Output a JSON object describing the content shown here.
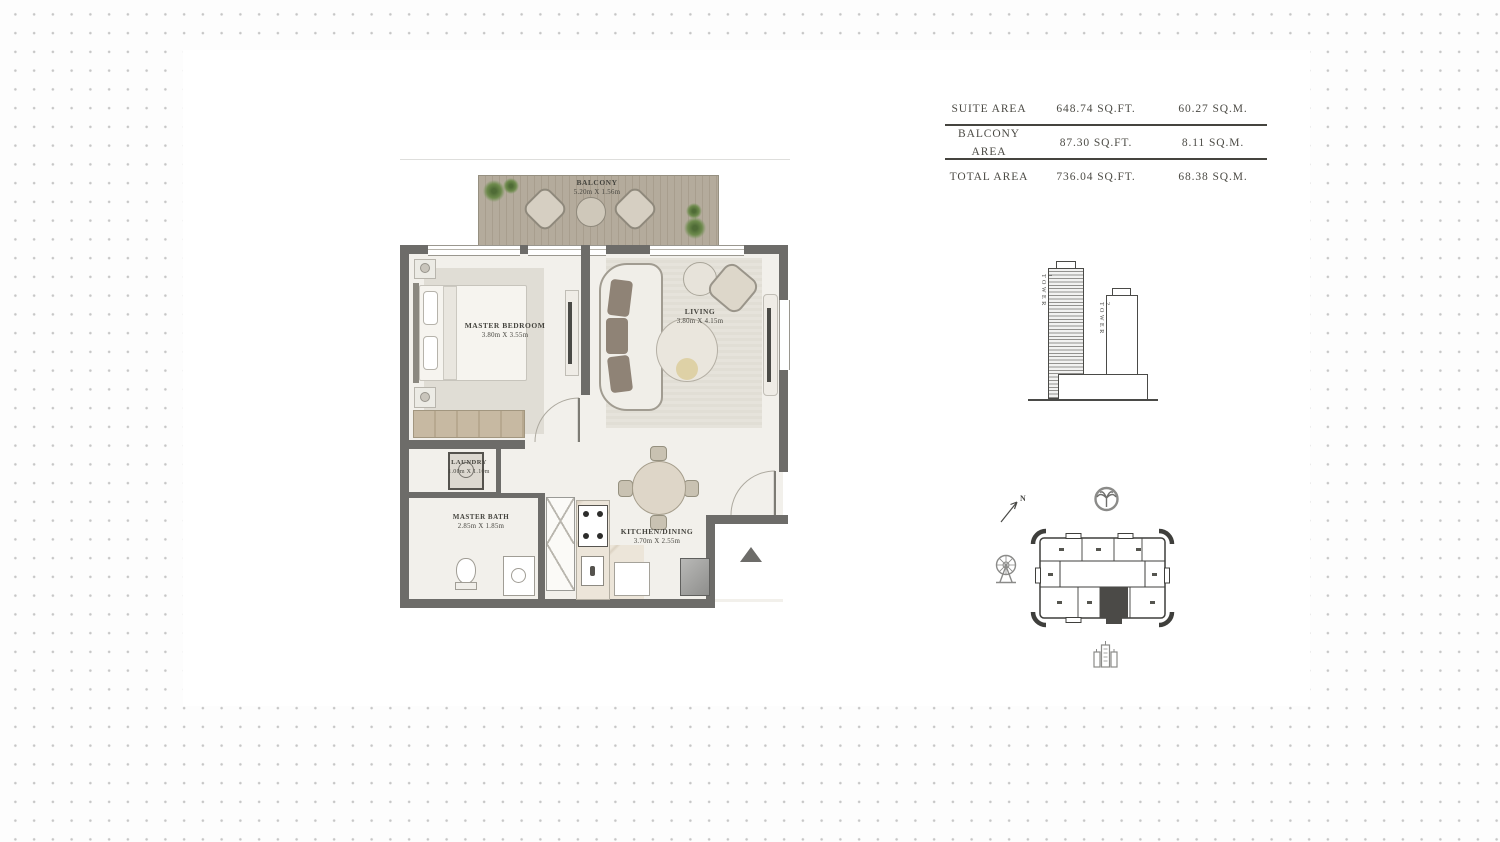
{
  "area_table": {
    "rows": [
      {
        "label": "SUITE AREA",
        "sqft": "648.74 SQ.FT.",
        "sqm": "60.27 SQ.M."
      },
      {
        "label": "BALCONY AREA",
        "sqft": "87.30 SQ.FT.",
        "sqm": "8.11 SQ.M."
      },
      {
        "label": "TOTAL AREA",
        "sqft": "736.04 SQ.FT.",
        "sqm": "68.38 SQ.M."
      }
    ]
  },
  "floor_plan": {
    "balcony": {
      "name": "BALCONY",
      "dims": "5.20m X 1.56m"
    },
    "master_bedroom": {
      "name": "MASTER BEDROOM",
      "dims": "3.80m X 3.55m"
    },
    "living": {
      "name": "LIVING",
      "dims": "3.80m X 4.15m"
    },
    "laundry": {
      "name": "LAUNDRY",
      "dims": "1.00m X 1.10m"
    },
    "master_bath": {
      "name": "MASTER BATH",
      "dims": "2.85m X 1.85m"
    },
    "kitchen_dining": {
      "name": "KITCHEN/DINING",
      "dims": "3.70m X 2.55m"
    }
  },
  "tower_diagram": {
    "tower1_label": "TOWER 1",
    "tower2_label": "TOWER 2"
  },
  "key_plan": {
    "north_label": "N"
  },
  "colors": {
    "wall": "#6d6c69",
    "deck": "#b2a898",
    "line": "#45443f",
    "plant_green": "#5d7a42"
  }
}
